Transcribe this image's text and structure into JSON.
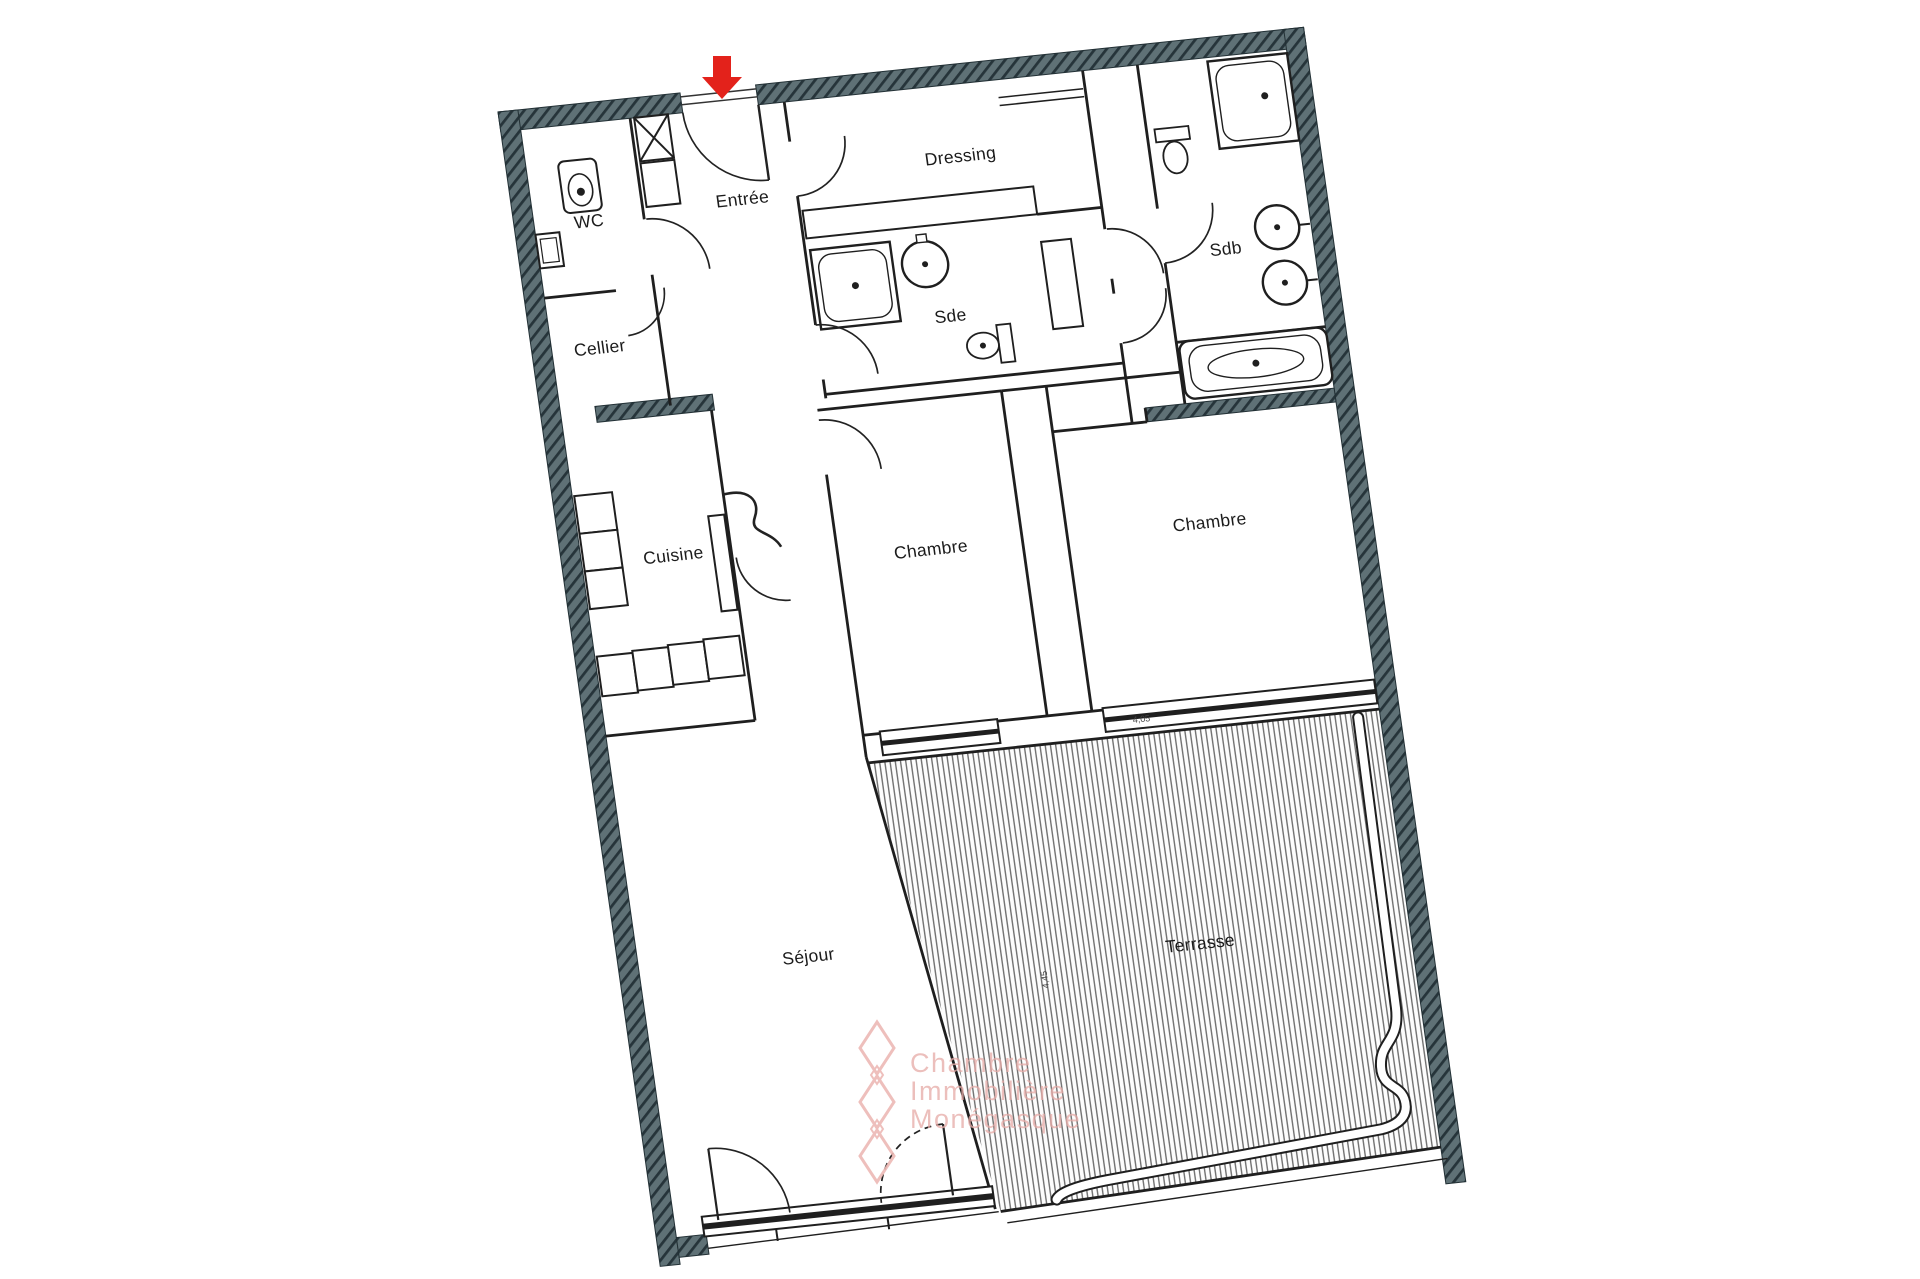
{
  "plan": {
    "rooms": {
      "wc": {
        "label": "WC"
      },
      "entree": {
        "label": "Entrée"
      },
      "dressing": {
        "label": "Dressing"
      },
      "cellier": {
        "label": "Cellier"
      },
      "sde": {
        "label": "Sde"
      },
      "sdb": {
        "label": "Sdb"
      },
      "cuisine": {
        "label": "Cuisine"
      },
      "chambre1": {
        "label": "Chambre"
      },
      "chambre2": {
        "label": "Chambre"
      },
      "sejour": {
        "label": "Séjour"
      },
      "terrasse": {
        "label": "Terrasse"
      }
    },
    "dimensions": {
      "terrasse_width": "4,05",
      "terrasse_depth": "4,45"
    },
    "entrance_arrow_color": "#e3221b"
  },
  "watermark": {
    "line1": "Chambre",
    "line2": "Immobilière",
    "line3": "Monégasque",
    "color": "#e7aca8"
  },
  "colors": {
    "wall_fill": "#5f7176",
    "wall_hatch": "#26343a",
    "line": "#1f1f1f",
    "terrace_stripe": "#707070"
  }
}
